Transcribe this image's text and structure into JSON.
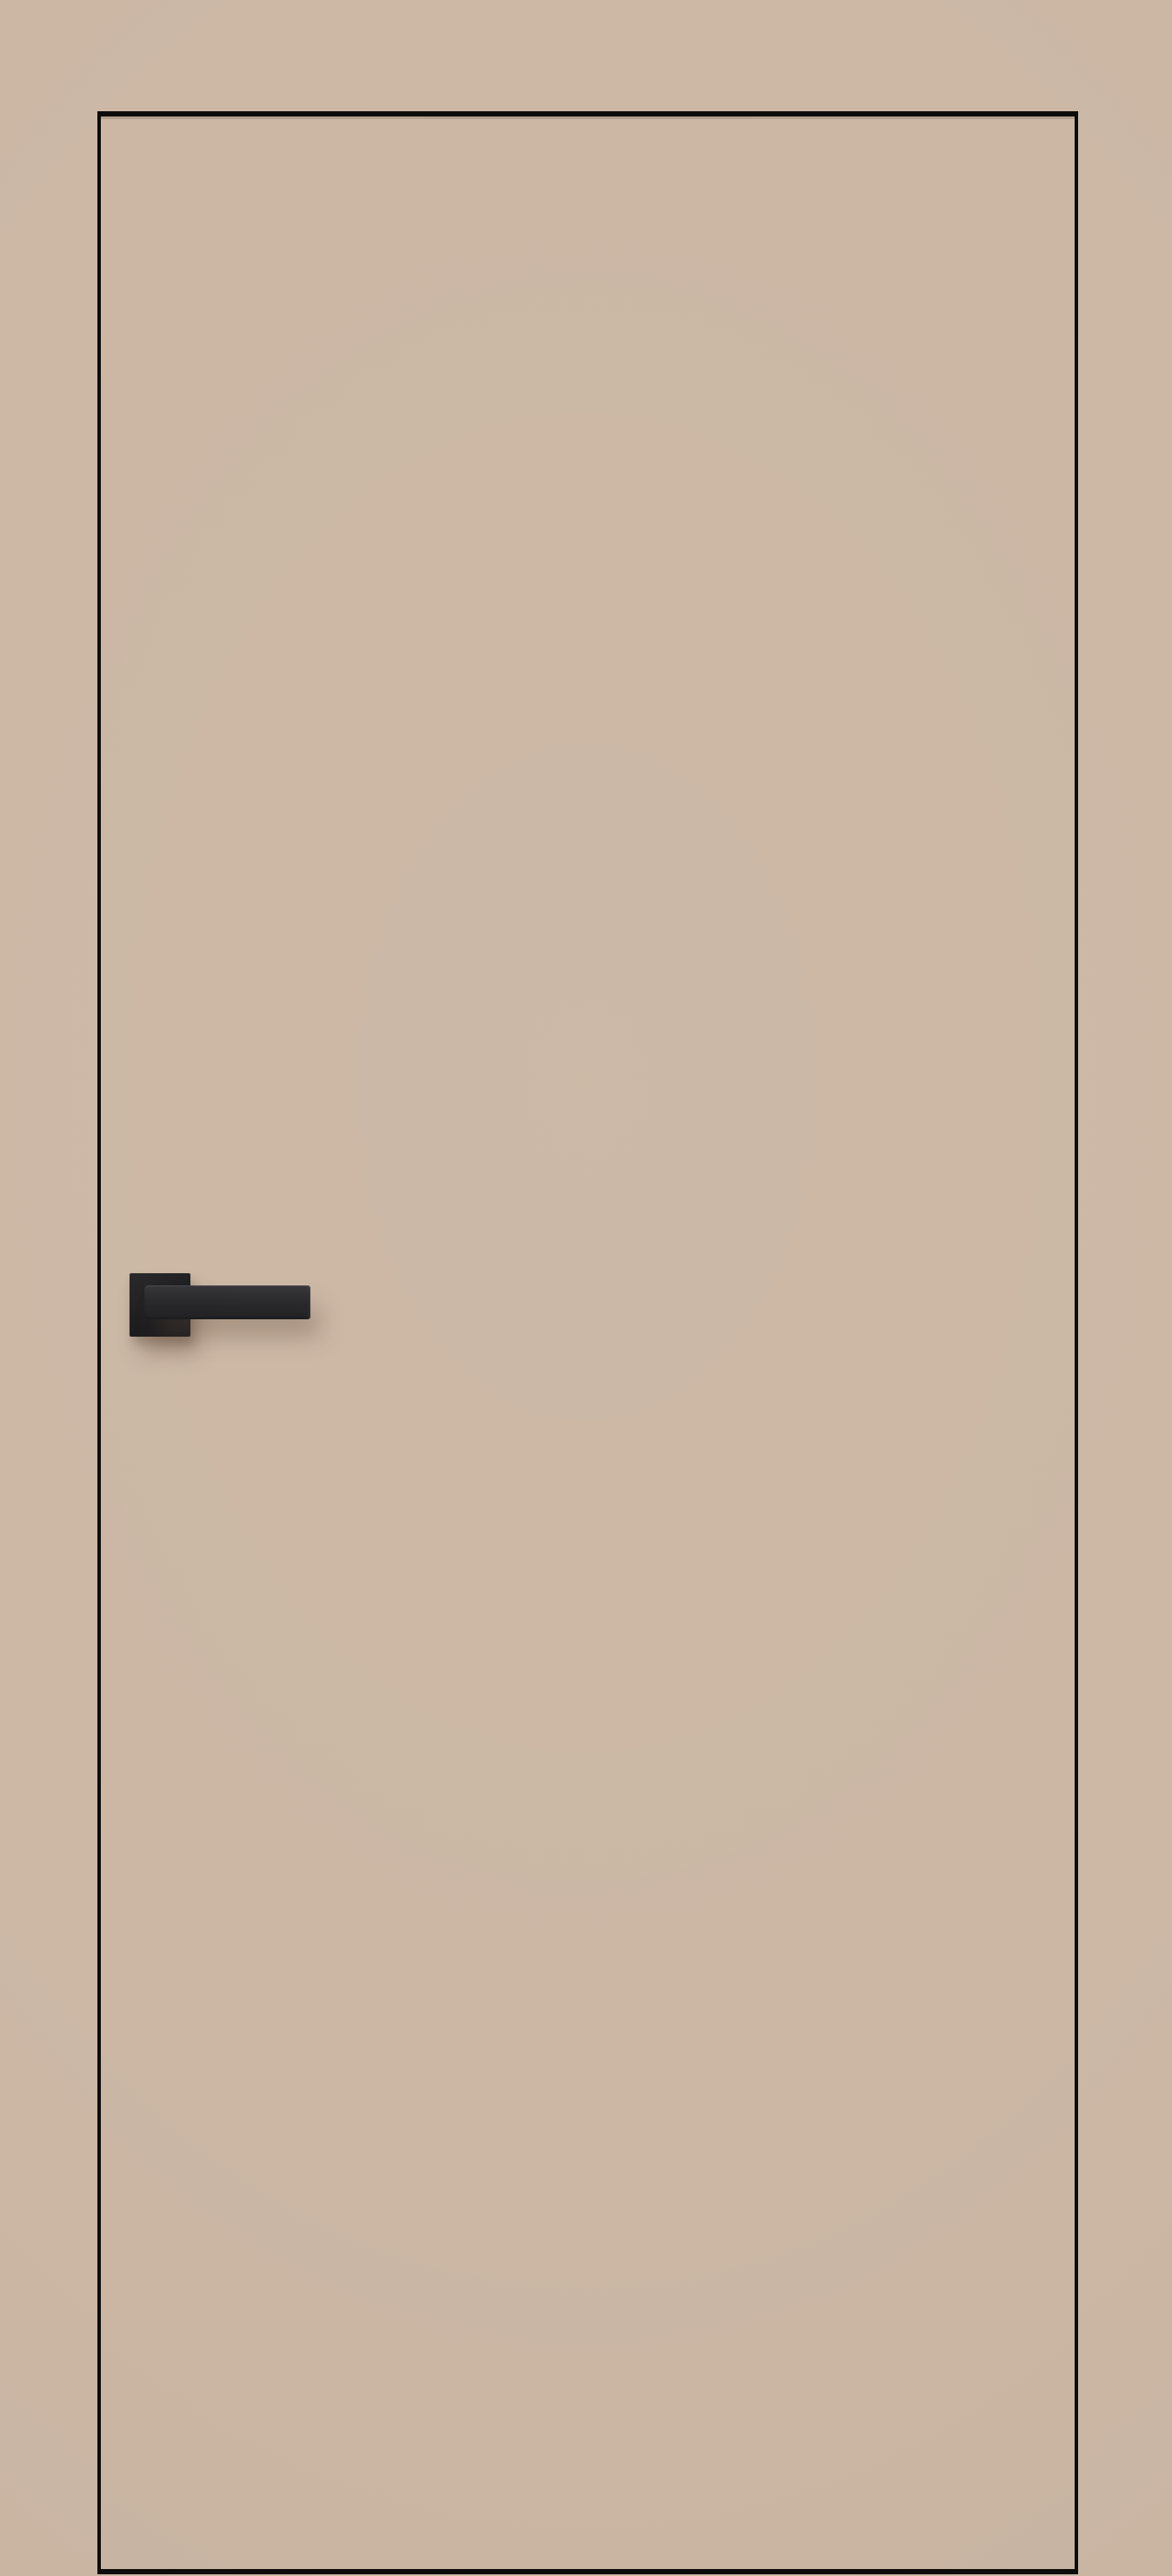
{
  "image": {
    "alt": "Beige flush interior door with a thin black edge outline and a matte black square-rosette lever handle, photographed against a matching beige wall"
  },
  "door": {
    "style": "flush",
    "handle_side": "left",
    "handle_type": "square-rosette lever"
  },
  "colors": {
    "wall": "#cdb8a6",
    "door_face": "#cbb7a4",
    "edge_line": "#0c0c0b",
    "rosette_dark": "#1c1c1e",
    "rosette_light": "#28282b",
    "lever_light": "#353539",
    "lever_dark": "#202022",
    "shadow_soft": "rgba(97,76,60,0.40)"
  }
}
